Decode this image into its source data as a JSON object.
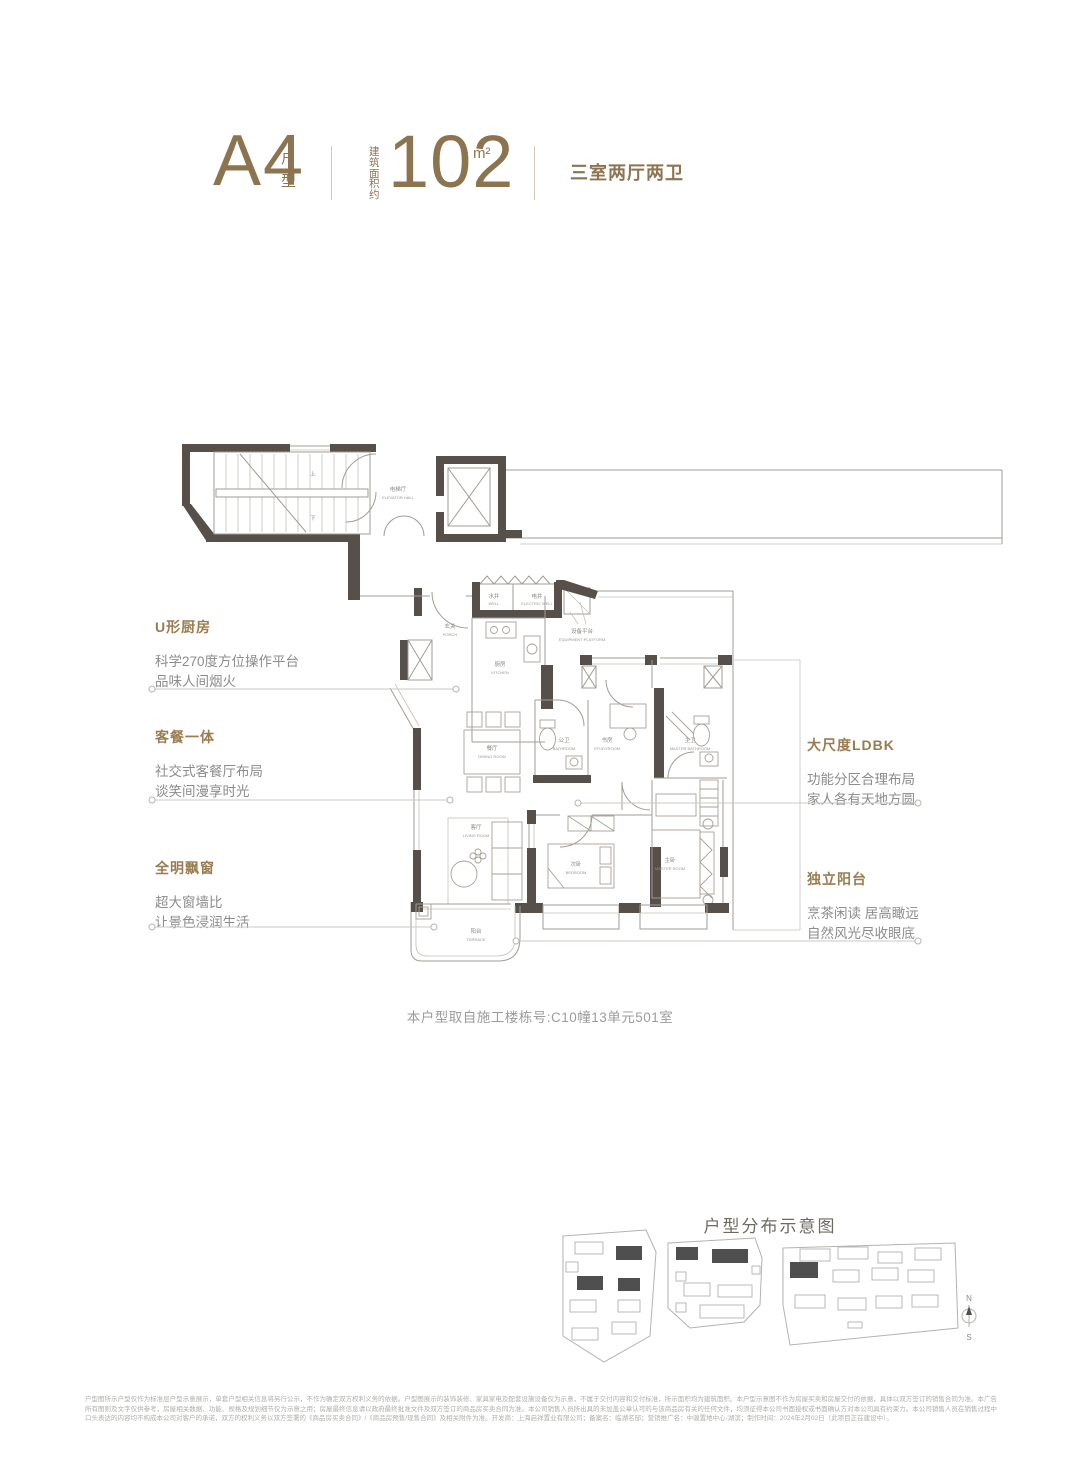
{
  "header": {
    "plan_code": "A4",
    "plan_type_label": "户型",
    "area_label": "建筑面积约",
    "area_value": "102",
    "area_unit": "m²",
    "rooms_summary": "三室两厅两卫"
  },
  "annotations": {
    "left": [
      {
        "title": "U形厨房",
        "lines": [
          "科学270度方位操作平台",
          "品味人间烟火"
        ]
      },
      {
        "title": "客餐一体",
        "lines": [
          "社交式客餐厅布局",
          "谈笑间漫享时光"
        ]
      },
      {
        "title": "全明飘窗",
        "lines": [
          "超大窗墙比",
          "让景色浸润生活"
        ]
      }
    ],
    "right": [
      {
        "title": "大尺度LDBK",
        "lines": [
          "功能分区合理布局",
          "家人各有天地方圆"
        ]
      },
      {
        "title": "独立阳台",
        "lines": [
          "烹茶闲读 居高瞰远",
          "自然风光尽收眼底"
        ]
      }
    ]
  },
  "floorplan": {
    "caption": "本户型取自施工楼栋号:C10幢13单元501室",
    "stairs": {
      "up": "上",
      "down": "下"
    },
    "rooms": {
      "elevator_hall": {
        "zh": "电梯厅",
        "en": "ELEVATOR HALL"
      },
      "well": {
        "zh": "水井",
        "en": "WELL"
      },
      "electric_well": {
        "zh": "电井",
        "en": "ELECTRIC WELL"
      },
      "porch": {
        "zh": "玄关",
        "en": "PORCH"
      },
      "kitchen": {
        "zh": "厨房",
        "en": "KITCHEN"
      },
      "equipment_platform": {
        "zh": "设备平台",
        "en": "EQUIPMENT PLATFORM"
      },
      "bathroom": {
        "zh": "公卫",
        "en": "BATHROOM"
      },
      "study": {
        "zh": "书房",
        "en": "STUDYROOM"
      },
      "master_bathroom": {
        "zh": "主卫",
        "en": "MASTER BATHROOM"
      },
      "dining": {
        "zh": "餐厅",
        "en": "DINING ROOM"
      },
      "living": {
        "zh": "客厅",
        "en": "LIVING ROOM"
      },
      "bedroom": {
        "zh": "次卧",
        "en": "BEDROOM"
      },
      "master_bedroom": {
        "zh": "主卧",
        "en": "MASTER ROOM"
      },
      "terrace": {
        "zh": "阳台",
        "en": "TERRACE"
      }
    }
  },
  "siteplan": {
    "title": "户型分布示意图",
    "compass_north": "N",
    "compass_south": "S"
  },
  "disclaimer": {
    "text": "户型图所示户型仅作为标准层户型示意展示，单套户型相关信息将另行公示，不作为确定双方权利义务的依据。户型图展示的装饰装修、家具家电及配套设施设备仅为示意，不属于交付内容和交付标准，所示面积均为建筑面积。本户型示意图不作为房屋买卖和房屋交付的依据，具体以双方签订的销售合同为准。本广告所有图则及文字仅供参考，房屋相关数据、功能、规格及规划细节仅为示意之用；房屋最终信息请以政府最终批准文件及双方签订的商品房买卖合同为准。本公司销售人员所出具的未加盖公章认可的与该商品房有关的任何文件，均须征得本公司书面授权或书面确认方对本公司具有约束力。本公司销售人员在销售过程中口头表达的内容均不构成本公司对客户的承诺，双方的权利义务以双方签署的《商品房买卖合同》/《商品房预售/现售合同》及相关附件为准。开发商：上海启祥置业有限公司；备案名：临湖名邸；营销推广名：中骏置地中心·湖滨；制作时间：2024年2月02日（此项目正在建设中）。"
  },
  "colors": {
    "accent_gold": "#8d7450",
    "wall_dark": "#57504a",
    "line_light": "#a29c95",
    "text_gray": "#8c8c8c",
    "site_dark_building": "#4f4f4f"
  }
}
